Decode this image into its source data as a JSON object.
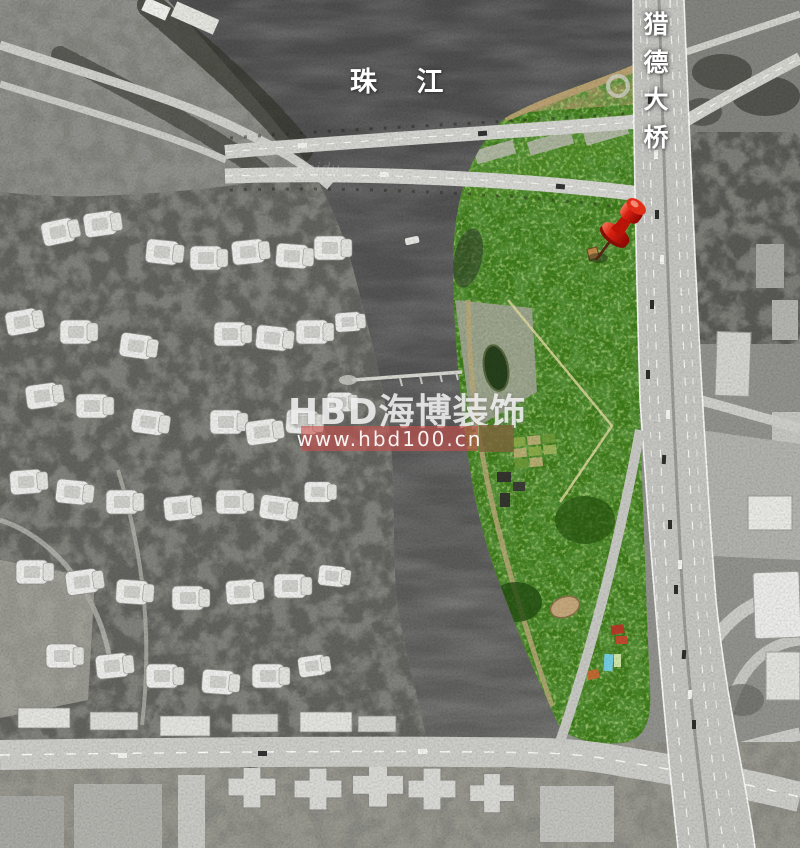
{
  "map": {
    "river_label": "珠 江",
    "bridge_label": "猎德大桥",
    "imagery_attribution": "Baidu",
    "marker": "red-pushpin",
    "colors": {
      "site_green": "#3e7b1b",
      "marker_red": "#d81e10",
      "river_gray": "#535353",
      "road_gray": "#c6c6c2"
    }
  },
  "watermark": {
    "brand": "HBD海博装饰",
    "url": "www.hbd100.cn",
    "band_color": "rgba(202,80,78,0.62)",
    "seal_color": "rgba(125,98,58,0.82)"
  }
}
